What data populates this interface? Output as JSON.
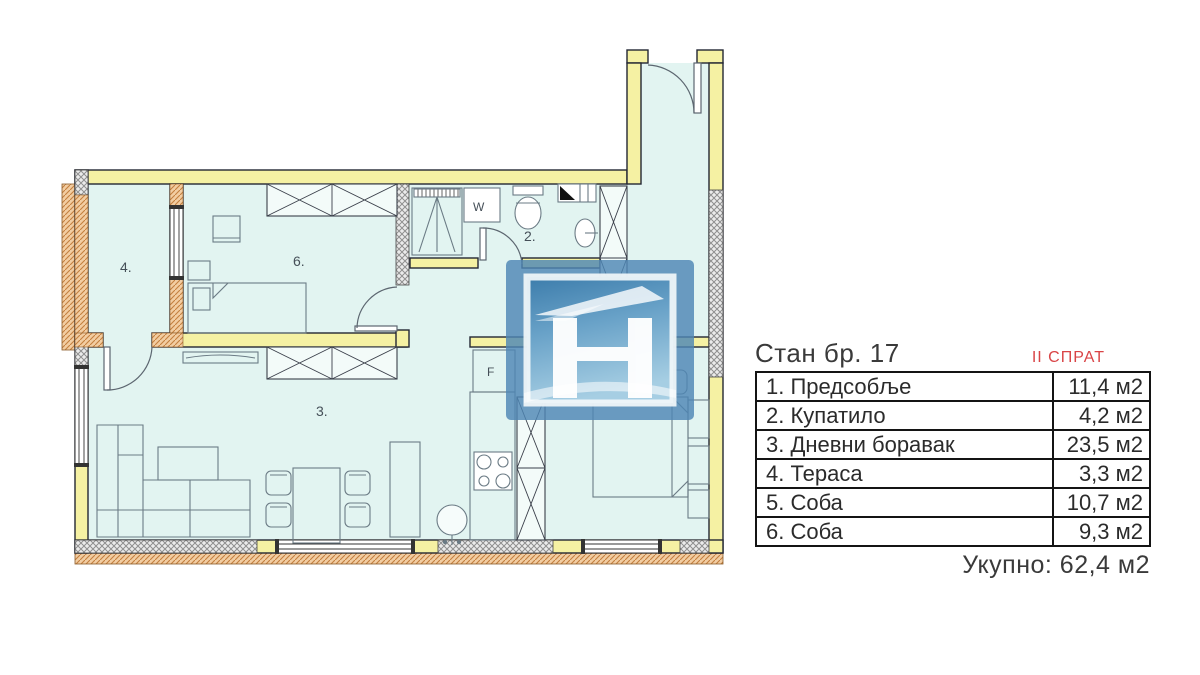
{
  "plan": {
    "room_labels": {
      "terrace": "4.",
      "bedroom6": "6.",
      "bathroom": "2.",
      "living": "3."
    },
    "appliance_labels": {
      "washer": "W",
      "fridge": "F"
    }
  },
  "panel": {
    "title": "Стан бр. 17",
    "floor": "II СПРАТ",
    "rows": [
      {
        "name": "1. Предсобље",
        "area": "11,4 м2"
      },
      {
        "name": "2. Купатило",
        "area": "4,2 м2"
      },
      {
        "name": "3. Дневни боравак",
        "area": "23,5 м2"
      },
      {
        "name": "4. Тераса",
        "area": "3,3 м2"
      },
      {
        "name": "5. Соба",
        "area": "10,7 м2"
      },
      {
        "name": "6. Соба",
        "area": "9,3 м2"
      }
    ],
    "total": "Укупно: 62,4 м2"
  },
  "colors": {
    "wall_yellow": "#f5f1a3",
    "floor_cyan": "#e2f4f1",
    "accent_red": "#d94446",
    "logo_blue": "#4e86b4",
    "hatch_orange": "#c4803f"
  }
}
